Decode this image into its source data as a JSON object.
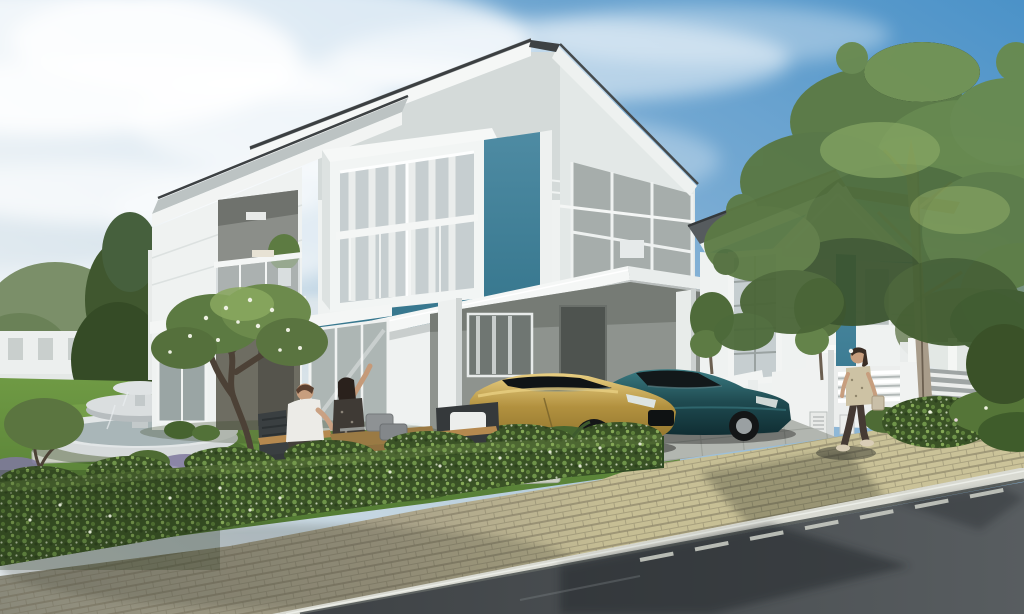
{
  "scene": {
    "type": "architectural-exterior-render",
    "objects": [
      "sky",
      "clouds",
      "main-house",
      "second-house",
      "carport",
      "gold-sports-car",
      "dark-sedan",
      "garden-fountain",
      "frangipani-tree",
      "large-tree",
      "hedge",
      "lawn",
      "stepping-stones",
      "outdoor-furniture",
      "seated-couple",
      "walking-woman",
      "sidewalk",
      "road",
      "boundary-walls"
    ]
  },
  "palette": {
    "sky_top": "#4b92c8",
    "sky_mid": "#7cadd4",
    "sky_pale": "#b9cfdd",
    "sky_horizon": "#e6ebed",
    "cloud": "#ffffff",
    "wall_white": "#eff2f1",
    "wall_shade": "#e3e8e7",
    "wall_gray_band": "#d4dad9",
    "trim_white": "#f5f7f6",
    "roof_dark": "#3b3f41",
    "roof_gray": "#bcc3c3",
    "roof_slope": "#565b5e",
    "teal_panel": "#4e8ba3",
    "teal_deep": "#38788f",
    "carport_wall": "#8e938e",
    "porch_wall": "#6e6d62",
    "door_dark": "#4e534f",
    "glass": "#c6ced0",
    "glass_dark": "#9aa5a4",
    "curtain": "#f4f6f5",
    "lawn_light": "#6f9a44",
    "lawn_dark": "#4c7330",
    "grass_shadow": "#2f4a22",
    "hedge_dark": "#3a5226",
    "hedge_light": "#7ca04f",
    "flower_white": "#eef2e0",
    "tree_green": "#5c7a42",
    "tree_light": "#8aa85f",
    "tree_shadow": "#3c5530",
    "trunk_pale": "#a89c8a",
    "trunk_dark": "#4c4136",
    "fountain_stone": "#d6dadb",
    "fountain_water": "#a9b6b8",
    "stone_pale": "#cdd0c4",
    "paver_beige": "#c6be94",
    "paver_mid": "#a8a189",
    "paver_shadow": "#8a897a",
    "driveway": "#b2b6b0",
    "curb": "#d9dad2",
    "road": "#3e4245",
    "road_light": "#585d60",
    "paint_white": "#e8e9e3",
    "car_gold": "#b2913f",
    "car_gold_hi": "#e9cf82",
    "car_gold_dark": "#8a6f2a",
    "car_teal": "#1f4a50",
    "car_teal_hi": "#3a7b82",
    "cabin_dark": "#12181a",
    "tire": "#141617",
    "rim": "#9aa0a2",
    "brake_orange": "#c27b2c",
    "skin": "#c79e7e",
    "shirt_white": "#ecebe7",
    "hair_brown": "#5a4030",
    "hair_dark": "#2a211c",
    "dress_dark": "#3f3a35",
    "top_beige": "#cdc2a4",
    "leggings": "#453a33",
    "wood": "#b5894f",
    "table_wood": "#9a7a44",
    "cushion": "#8e9294",
    "fence_white": "#f0f2f1",
    "meter_box": "#e8eae8"
  }
}
